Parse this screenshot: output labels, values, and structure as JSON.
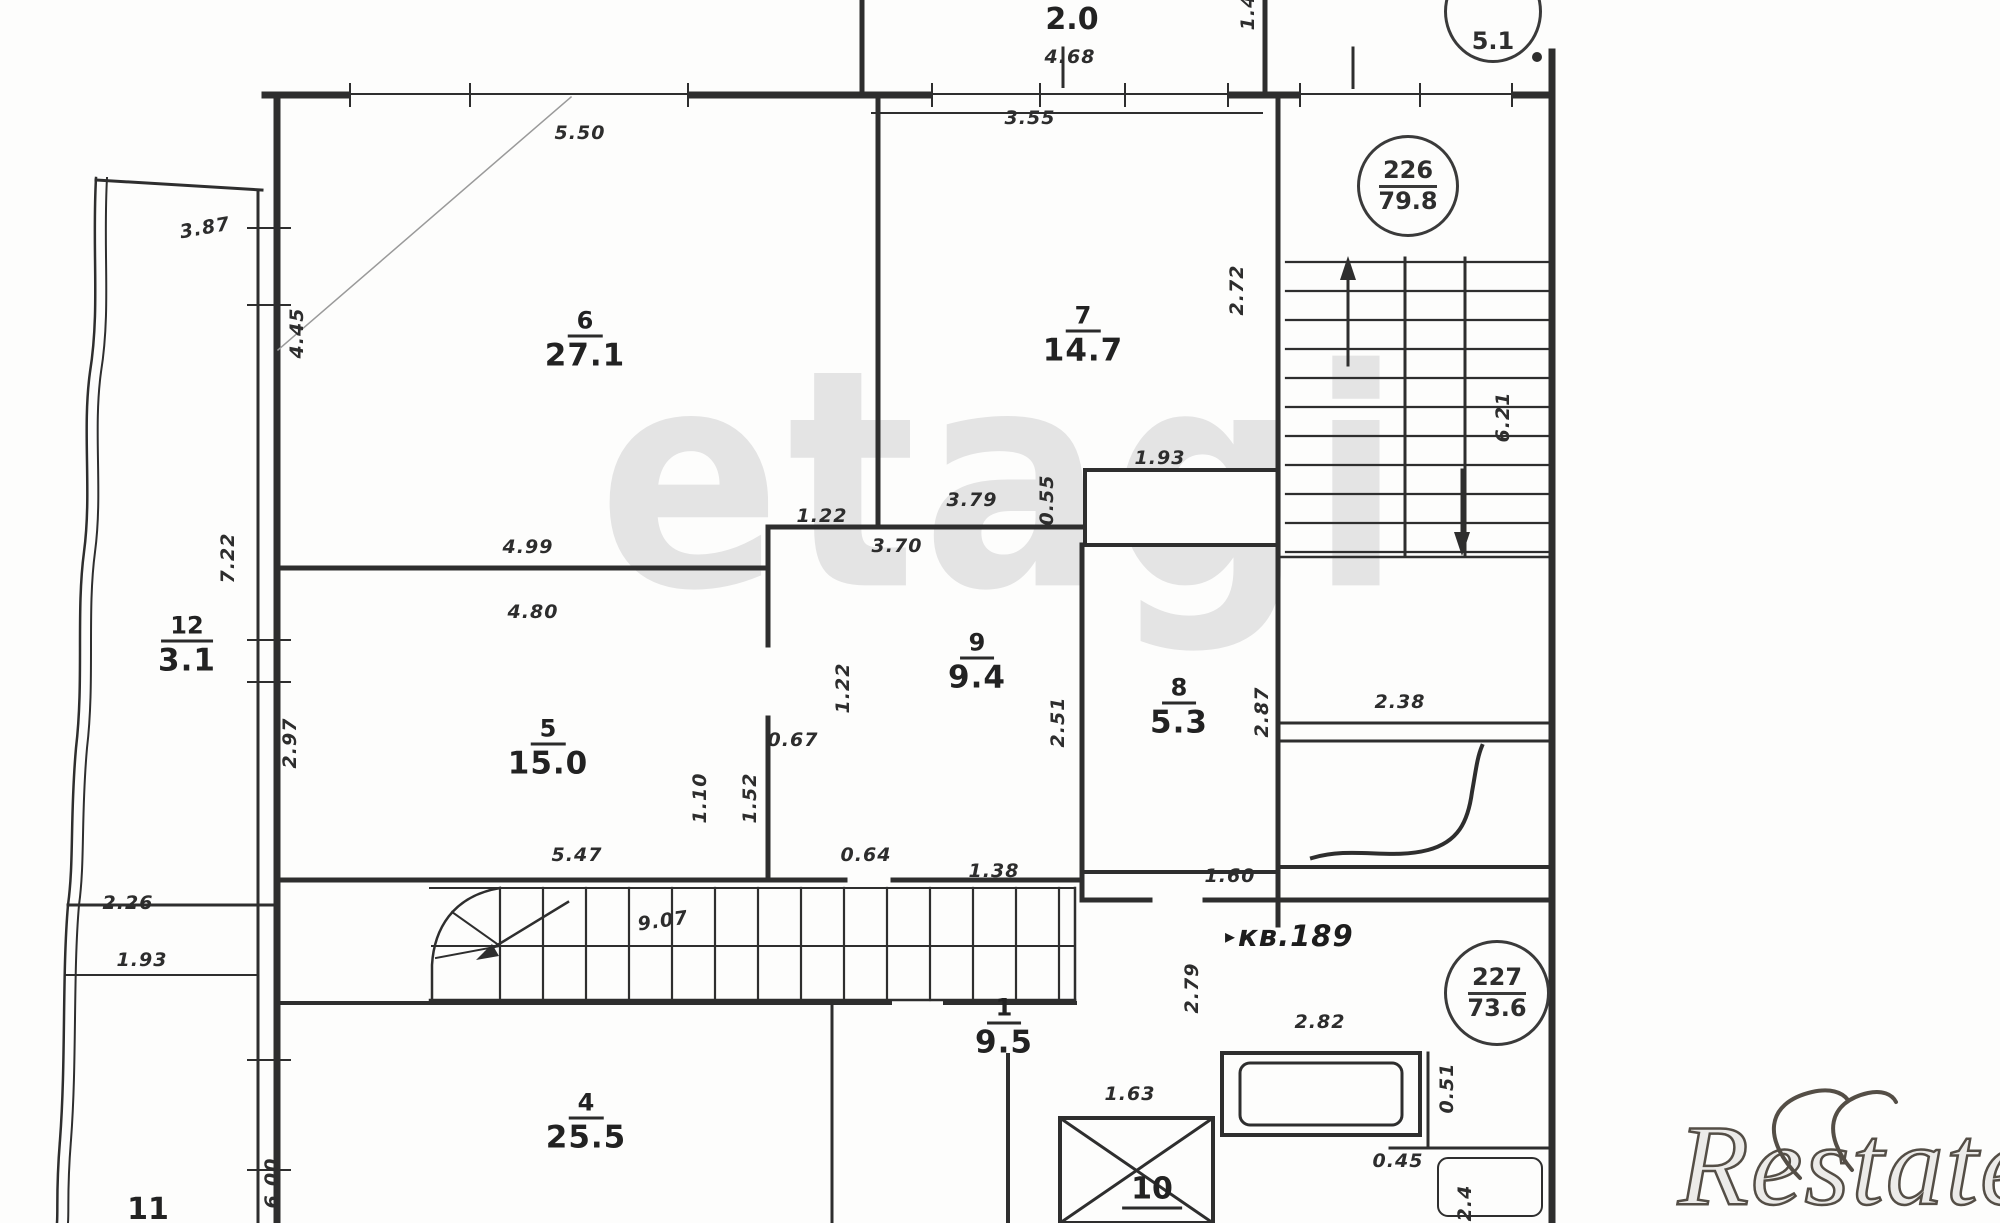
{
  "colors": {
    "ink": "#2e2e2e",
    "label_ink": "#222222",
    "watermark_gray": "#e4e4e4",
    "watermark_dark": "#544e46",
    "paper": "#fdfdfc"
  },
  "watermarks": {
    "center_text": "etagi",
    "corner_text": "Restate"
  },
  "apartment_label": {
    "arrow": "▸",
    "text": "кв.189"
  },
  "plan": {
    "rooms": [
      {
        "num": "6",
        "area": "27.1",
        "x": 585,
        "y": 340
      },
      {
        "num": "7",
        "area": "14.7",
        "x": 1083,
        "y": 335
      },
      {
        "num": "12",
        "area": "3.1",
        "x": 187,
        "y": 645
      },
      {
        "num": "5",
        "area": "15.0",
        "x": 548,
        "y": 748
      },
      {
        "num": "9",
        "area": "9.4",
        "x": 977,
        "y": 662
      },
      {
        "num": "8",
        "area": "5.3",
        "x": 1179,
        "y": 707
      },
      {
        "num": "1",
        "area": "9.5",
        "x": 1004,
        "y": 1027
      },
      {
        "num": "4",
        "area": "25.5",
        "x": 586,
        "y": 1122
      },
      {
        "num": "10",
        "area": "",
        "underline": true,
        "x": 1152,
        "y": 1192
      },
      {
        "num": "11",
        "area": "",
        "x": 148,
        "y": 1210
      },
      {
        "num": "",
        "area": "2.0",
        "x": 1072,
        "y": 20
      }
    ],
    "stamps": [
      {
        "top": "226",
        "bottom": "79.8",
        "x": 1405,
        "y": 183,
        "r": 48,
        "partial": false
      },
      {
        "top": "227",
        "bottom": "73.6",
        "x": 1494,
        "y": 990,
        "r": 50,
        "partial": false
      },
      {
        "top": "5.1",
        "bottom": "",
        "x": 1490,
        "y": 6,
        "r": 46,
        "partial": true
      }
    ],
    "dimensions": [
      {
        "t": "5.50",
        "x": 580,
        "y": 133,
        "r": 0
      },
      {
        "t": "3.55",
        "x": 1030,
        "y": 118,
        "r": 0
      },
      {
        "t": "4.68",
        "x": 1070,
        "y": 57,
        "r": 0
      },
      {
        "t": "1.4",
        "x": 1248,
        "y": 12,
        "r": -90
      },
      {
        "t": "3.87",
        "x": 205,
        "y": 228,
        "r": -10
      },
      {
        "t": "4.45",
        "x": 297,
        "y": 333,
        "r": -90
      },
      {
        "t": "7.22",
        "x": 228,
        "y": 558,
        "r": -90
      },
      {
        "t": "2.97",
        "x": 290,
        "y": 743,
        "r": -90
      },
      {
        "t": "4.99",
        "x": 528,
        "y": 547,
        "r": 0
      },
      {
        "t": "4.80",
        "x": 533,
        "y": 612,
        "r": 0
      },
      {
        "t": "1.22",
        "x": 822,
        "y": 516,
        "r": 0
      },
      {
        "t": "3.70",
        "x": 897,
        "y": 546,
        "r": 0
      },
      {
        "t": "3.79",
        "x": 972,
        "y": 500,
        "r": 0
      },
      {
        "t": "0.55",
        "x": 1047,
        "y": 500,
        "r": -90
      },
      {
        "t": "1.93",
        "x": 1160,
        "y": 458,
        "r": 0
      },
      {
        "t": "2.72",
        "x": 1237,
        "y": 290,
        "r": -90
      },
      {
        "t": "1.22",
        "x": 843,
        "y": 688,
        "r": -90
      },
      {
        "t": "2.51",
        "x": 1058,
        "y": 722,
        "r": -90
      },
      {
        "t": "2.87",
        "x": 1262,
        "y": 712,
        "r": -90
      },
      {
        "t": "0.67",
        "x": 793,
        "y": 740,
        "r": 0
      },
      {
        "t": "1.10",
        "x": 700,
        "y": 798,
        "r": -90
      },
      {
        "t": "1.52",
        "x": 750,
        "y": 798,
        "r": -90
      },
      {
        "t": "5.47",
        "x": 577,
        "y": 855,
        "r": 0
      },
      {
        "t": "0.64",
        "x": 866,
        "y": 855,
        "r": 0
      },
      {
        "t": "1.38",
        "x": 994,
        "y": 871,
        "r": 0
      },
      {
        "t": "9.07",
        "x": 663,
        "y": 921,
        "r": -8
      },
      {
        "t": "1.60",
        "x": 1230,
        "y": 876,
        "r": 0
      },
      {
        "t": "2.38",
        "x": 1400,
        "y": 702,
        "r": 0
      },
      {
        "t": "6.21",
        "x": 1503,
        "y": 417,
        "r": -90
      },
      {
        "t": "2.79",
        "x": 1192,
        "y": 988,
        "r": -90
      },
      {
        "t": "2.82",
        "x": 1320,
        "y": 1022,
        "r": 0
      },
      {
        "t": "1.63",
        "x": 1130,
        "y": 1094,
        "r": 0
      },
      {
        "t": "0.51",
        "x": 1447,
        "y": 1088,
        "r": -90
      },
      {
        "t": "0.45",
        "x": 1398,
        "y": 1161,
        "r": 0
      },
      {
        "t": "2.4",
        "x": 1465,
        "y": 1203,
        "r": -90
      },
      {
        "t": "2.26",
        "x": 128,
        "y": 903,
        "r": 0
      },
      {
        "t": "1.93",
        "x": 142,
        "y": 960,
        "r": 0
      },
      {
        "t": "6.00",
        "x": 272,
        "y": 1183,
        "r": -90
      }
    ]
  }
}
